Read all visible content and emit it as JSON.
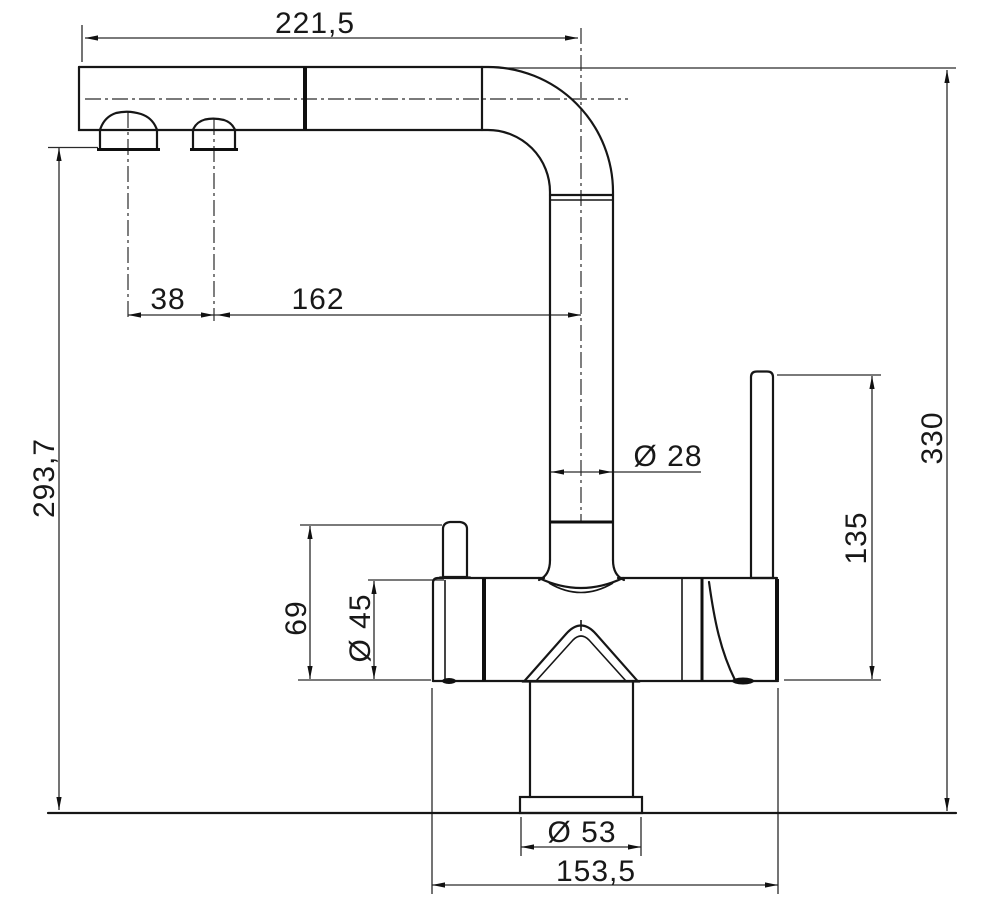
{
  "drawing": {
    "subject": "kitchen-faucet-technical-drawing-side-view",
    "background": "#ffffff",
    "line_color": "#161616",
    "dimensions": {
      "spout_reach": "221,5",
      "aerator_spacing": "38",
      "aerator_to_riser_axis": "162",
      "outlet_height": "293,7",
      "riser_diameter": "Ø 28",
      "total_height": "330",
      "lever_height": "135",
      "body_height_with_knob": "69",
      "body_diameter": "Ø 45",
      "base_diameter": "Ø 53",
      "body_length": "153,5"
    }
  }
}
